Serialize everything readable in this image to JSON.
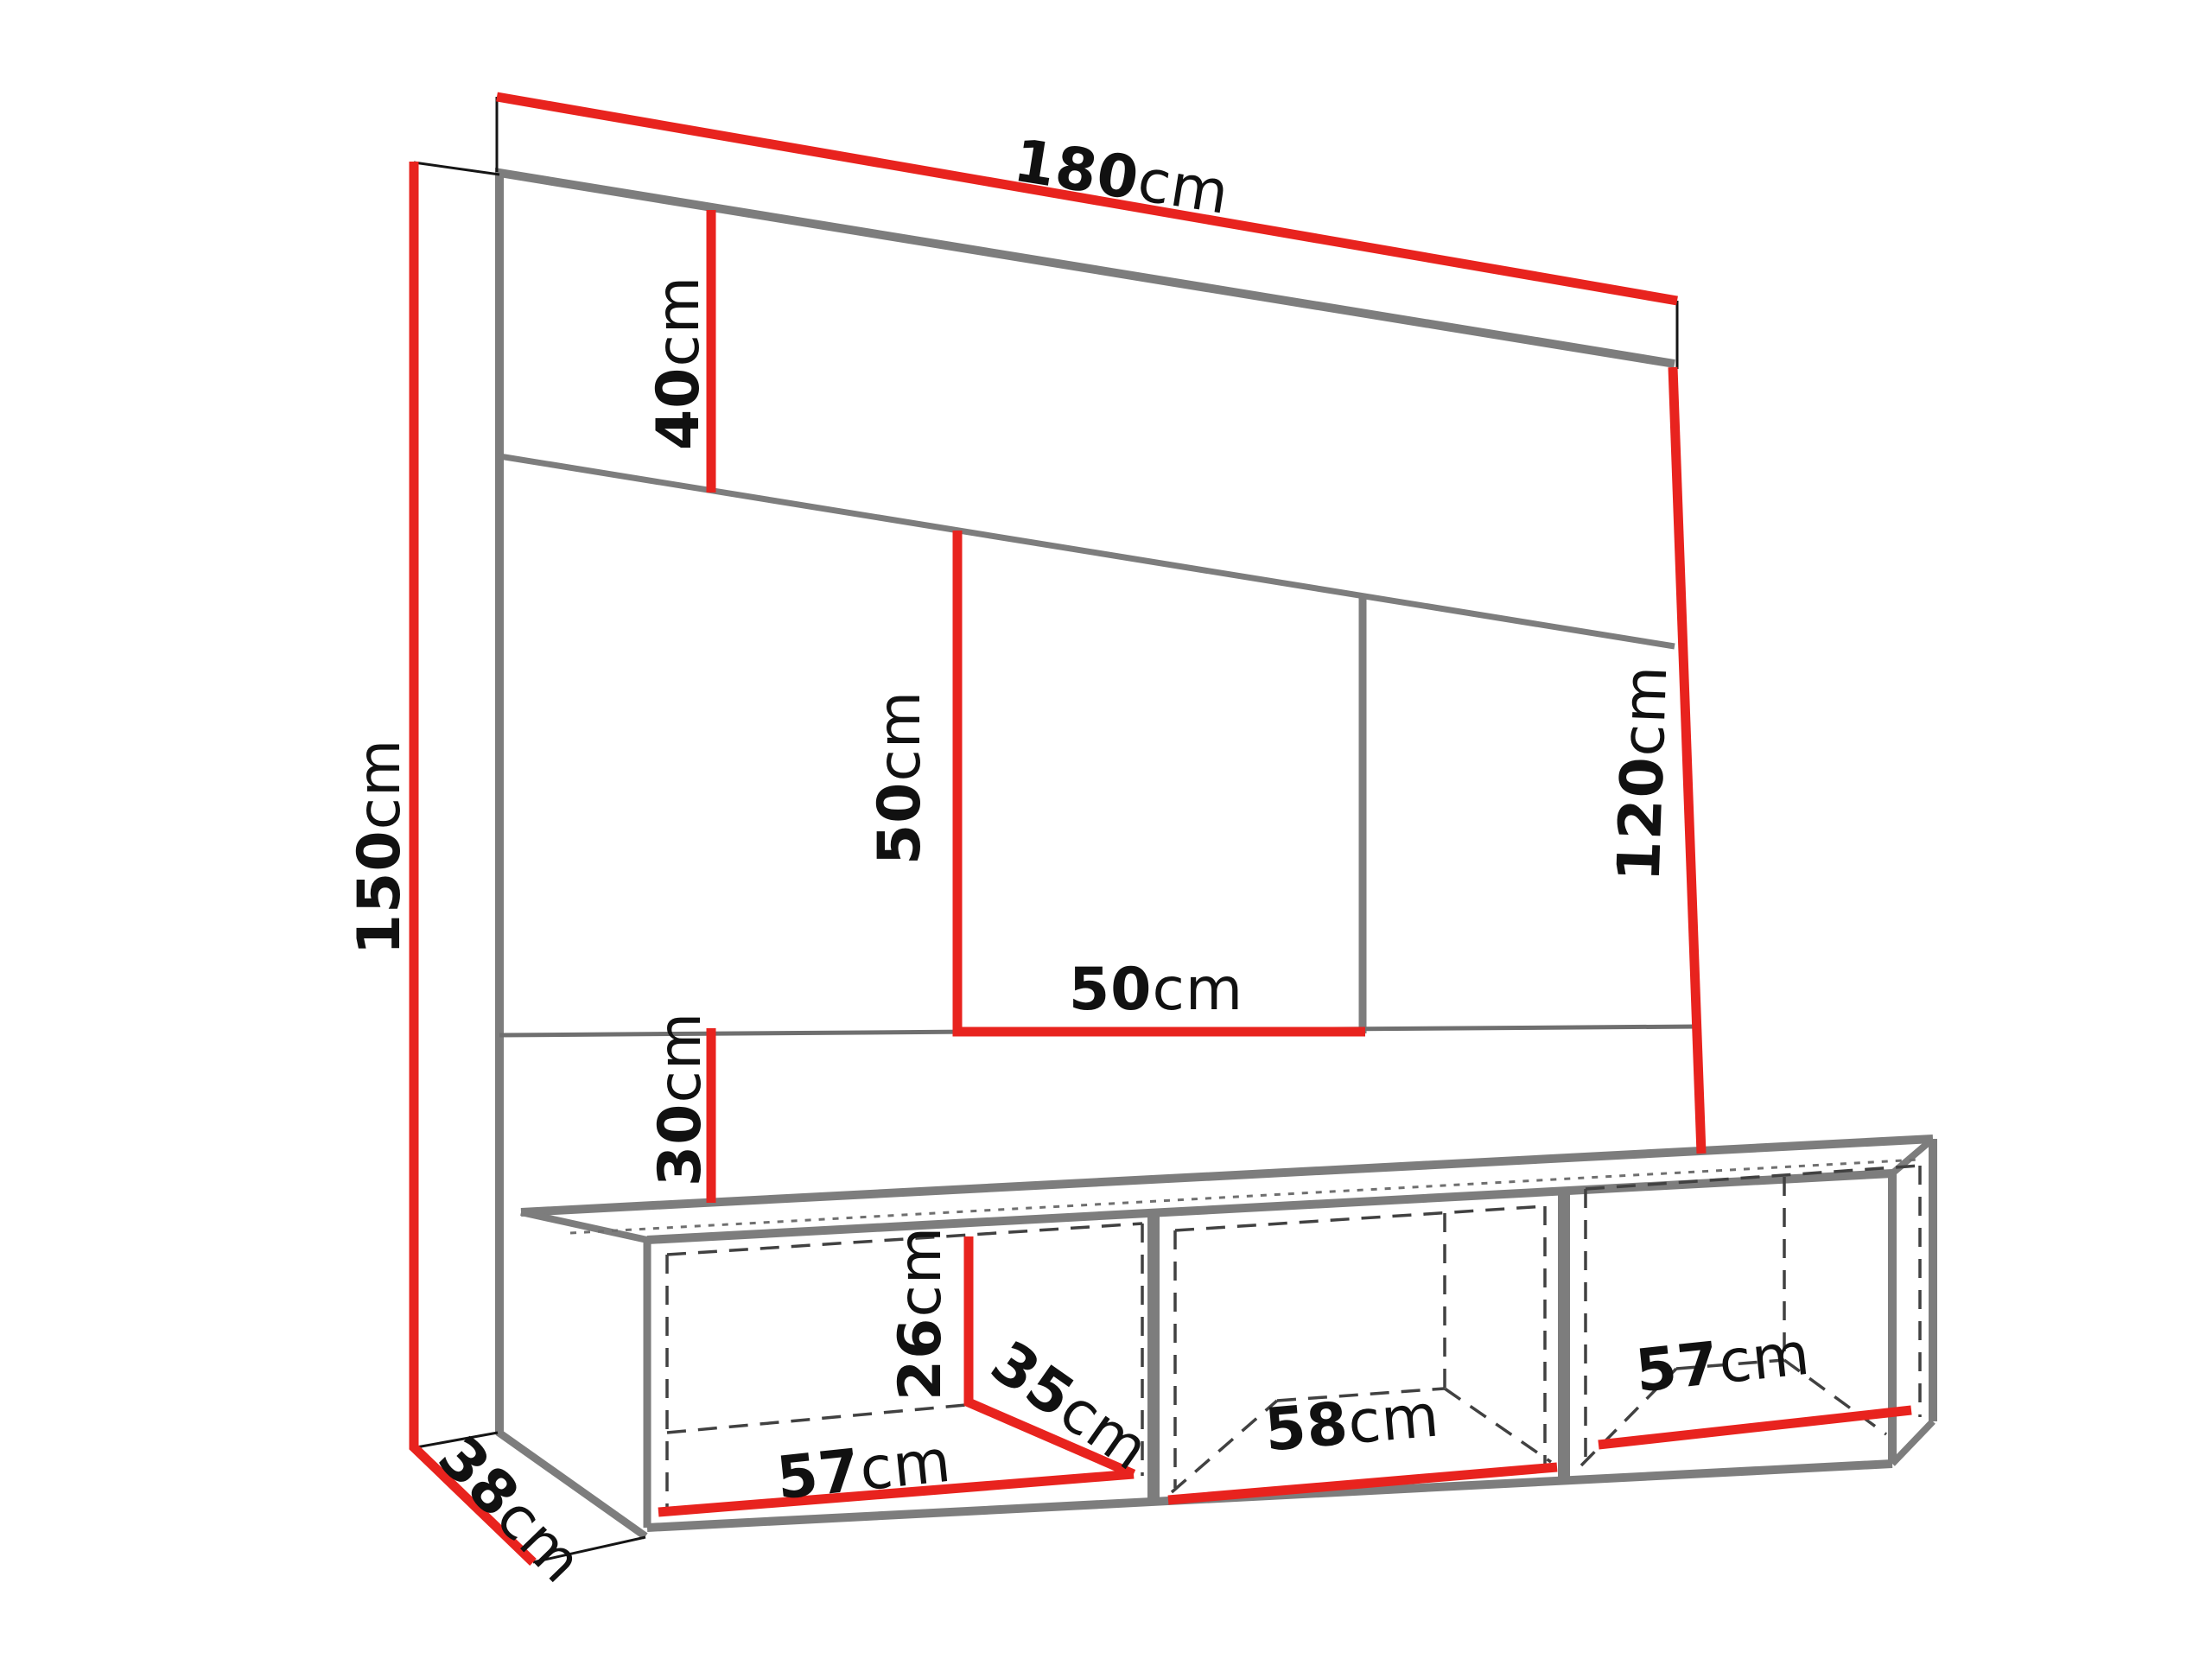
{
  "colors": {
    "dimension_line": "#E8231E",
    "structure_line": "#7D7D7D",
    "hidden_line": "#414141",
    "extension_line": "#151515",
    "text": "#111111",
    "background": "#FFFFFF"
  },
  "labels": {
    "total_width": {
      "value": "180",
      "unit": "cm"
    },
    "total_height": {
      "value": "150",
      "unit": "cm"
    },
    "top_panel_height": {
      "value": "40",
      "unit": "cm"
    },
    "niche_height": {
      "value": "50",
      "unit": "cm"
    },
    "niche_width": {
      "value": "50",
      "unit": "cm"
    },
    "right_panel_height": {
      "value": "120",
      "unit": "cm"
    },
    "bottom_gap_height": {
      "value": "30",
      "unit": "cm"
    },
    "cabinet_inner_height": {
      "value": "26",
      "unit": "cm"
    },
    "cabinet_inner_depth": {
      "value": "35",
      "unit": "cm"
    },
    "compartment_left_width": {
      "value": "57",
      "unit": "cm"
    },
    "compartment_middle_width": {
      "value": "58",
      "unit": "cm"
    },
    "compartment_right_width": {
      "value": "57",
      "unit": "cm"
    },
    "base_depth": {
      "value": "38",
      "unit": "cm"
    }
  }
}
